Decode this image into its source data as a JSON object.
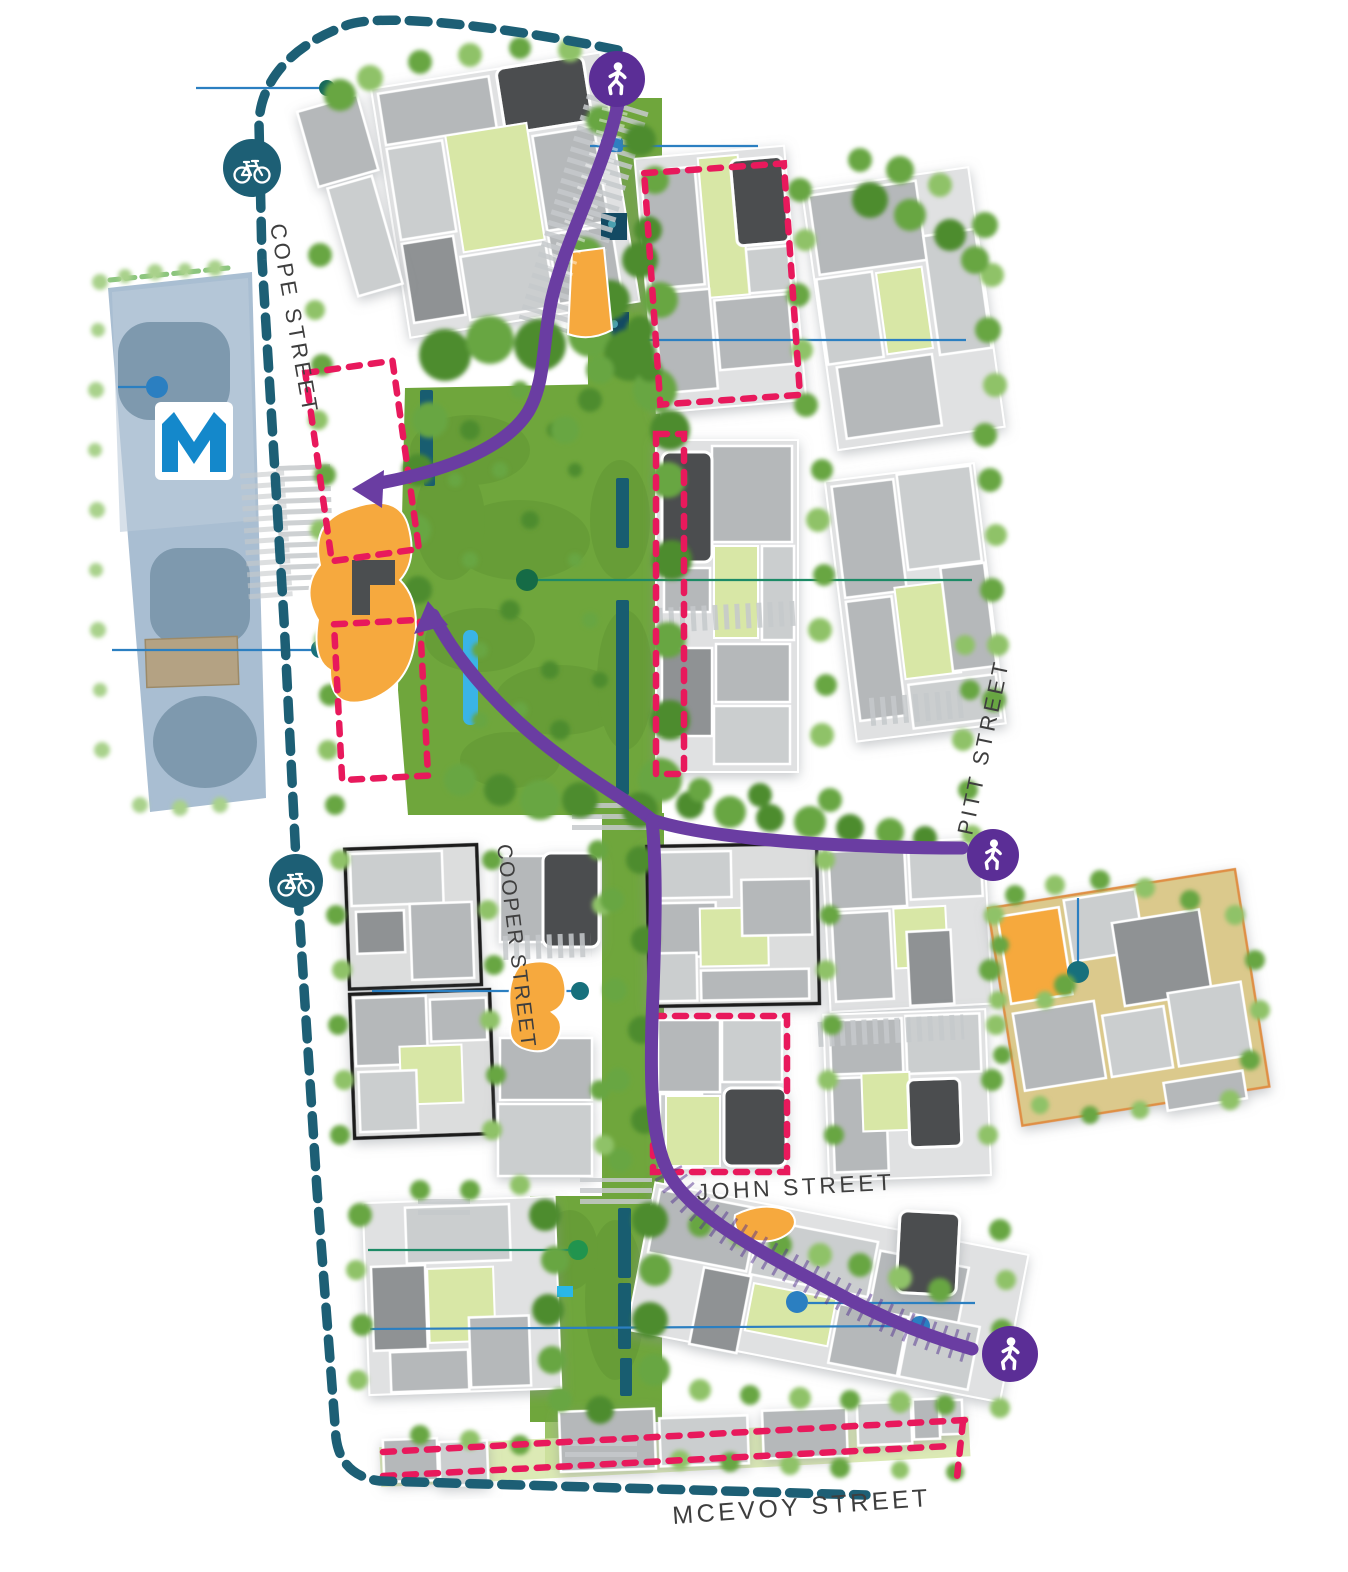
{
  "streets": {
    "cope": "COPE STREET",
    "pitt": "PITT STREET",
    "cooper": "COOPER STREET",
    "john": "JOHN STREET",
    "mcevoy": "MCEVOY STREET"
  },
  "metro": {
    "logo": "M"
  },
  "markers": {
    "pedestrian_access": {
      "icon": "pedestrian-icon",
      "count": 3
    },
    "cycle_route": {
      "icon": "bicycle-icon",
      "count": 2
    }
  },
  "colors": {
    "cycle_route": "#1d5f75",
    "pedestrian_route": "#6a3da2",
    "pedestrian_badge": "#5b2e96",
    "highlight_outline": "#e8195c",
    "amenity_orange": "#f6a93e",
    "park_green": "#6fa63c",
    "courtyard_green": "#d8e7a6",
    "building_grey": "#b6b9bb",
    "building_dark": "#4b4e50",
    "heritage_outline": "#1a1a1a",
    "metro_site": "#a9bed2",
    "metro_logo": "#1488cb",
    "leader_blue": "#2b7fc1",
    "leader_teal": "#17707c",
    "precinct_tan": "#dbc98c",
    "precinct_border": "#df8f45",
    "water_blue": "#3ab4e6"
  }
}
